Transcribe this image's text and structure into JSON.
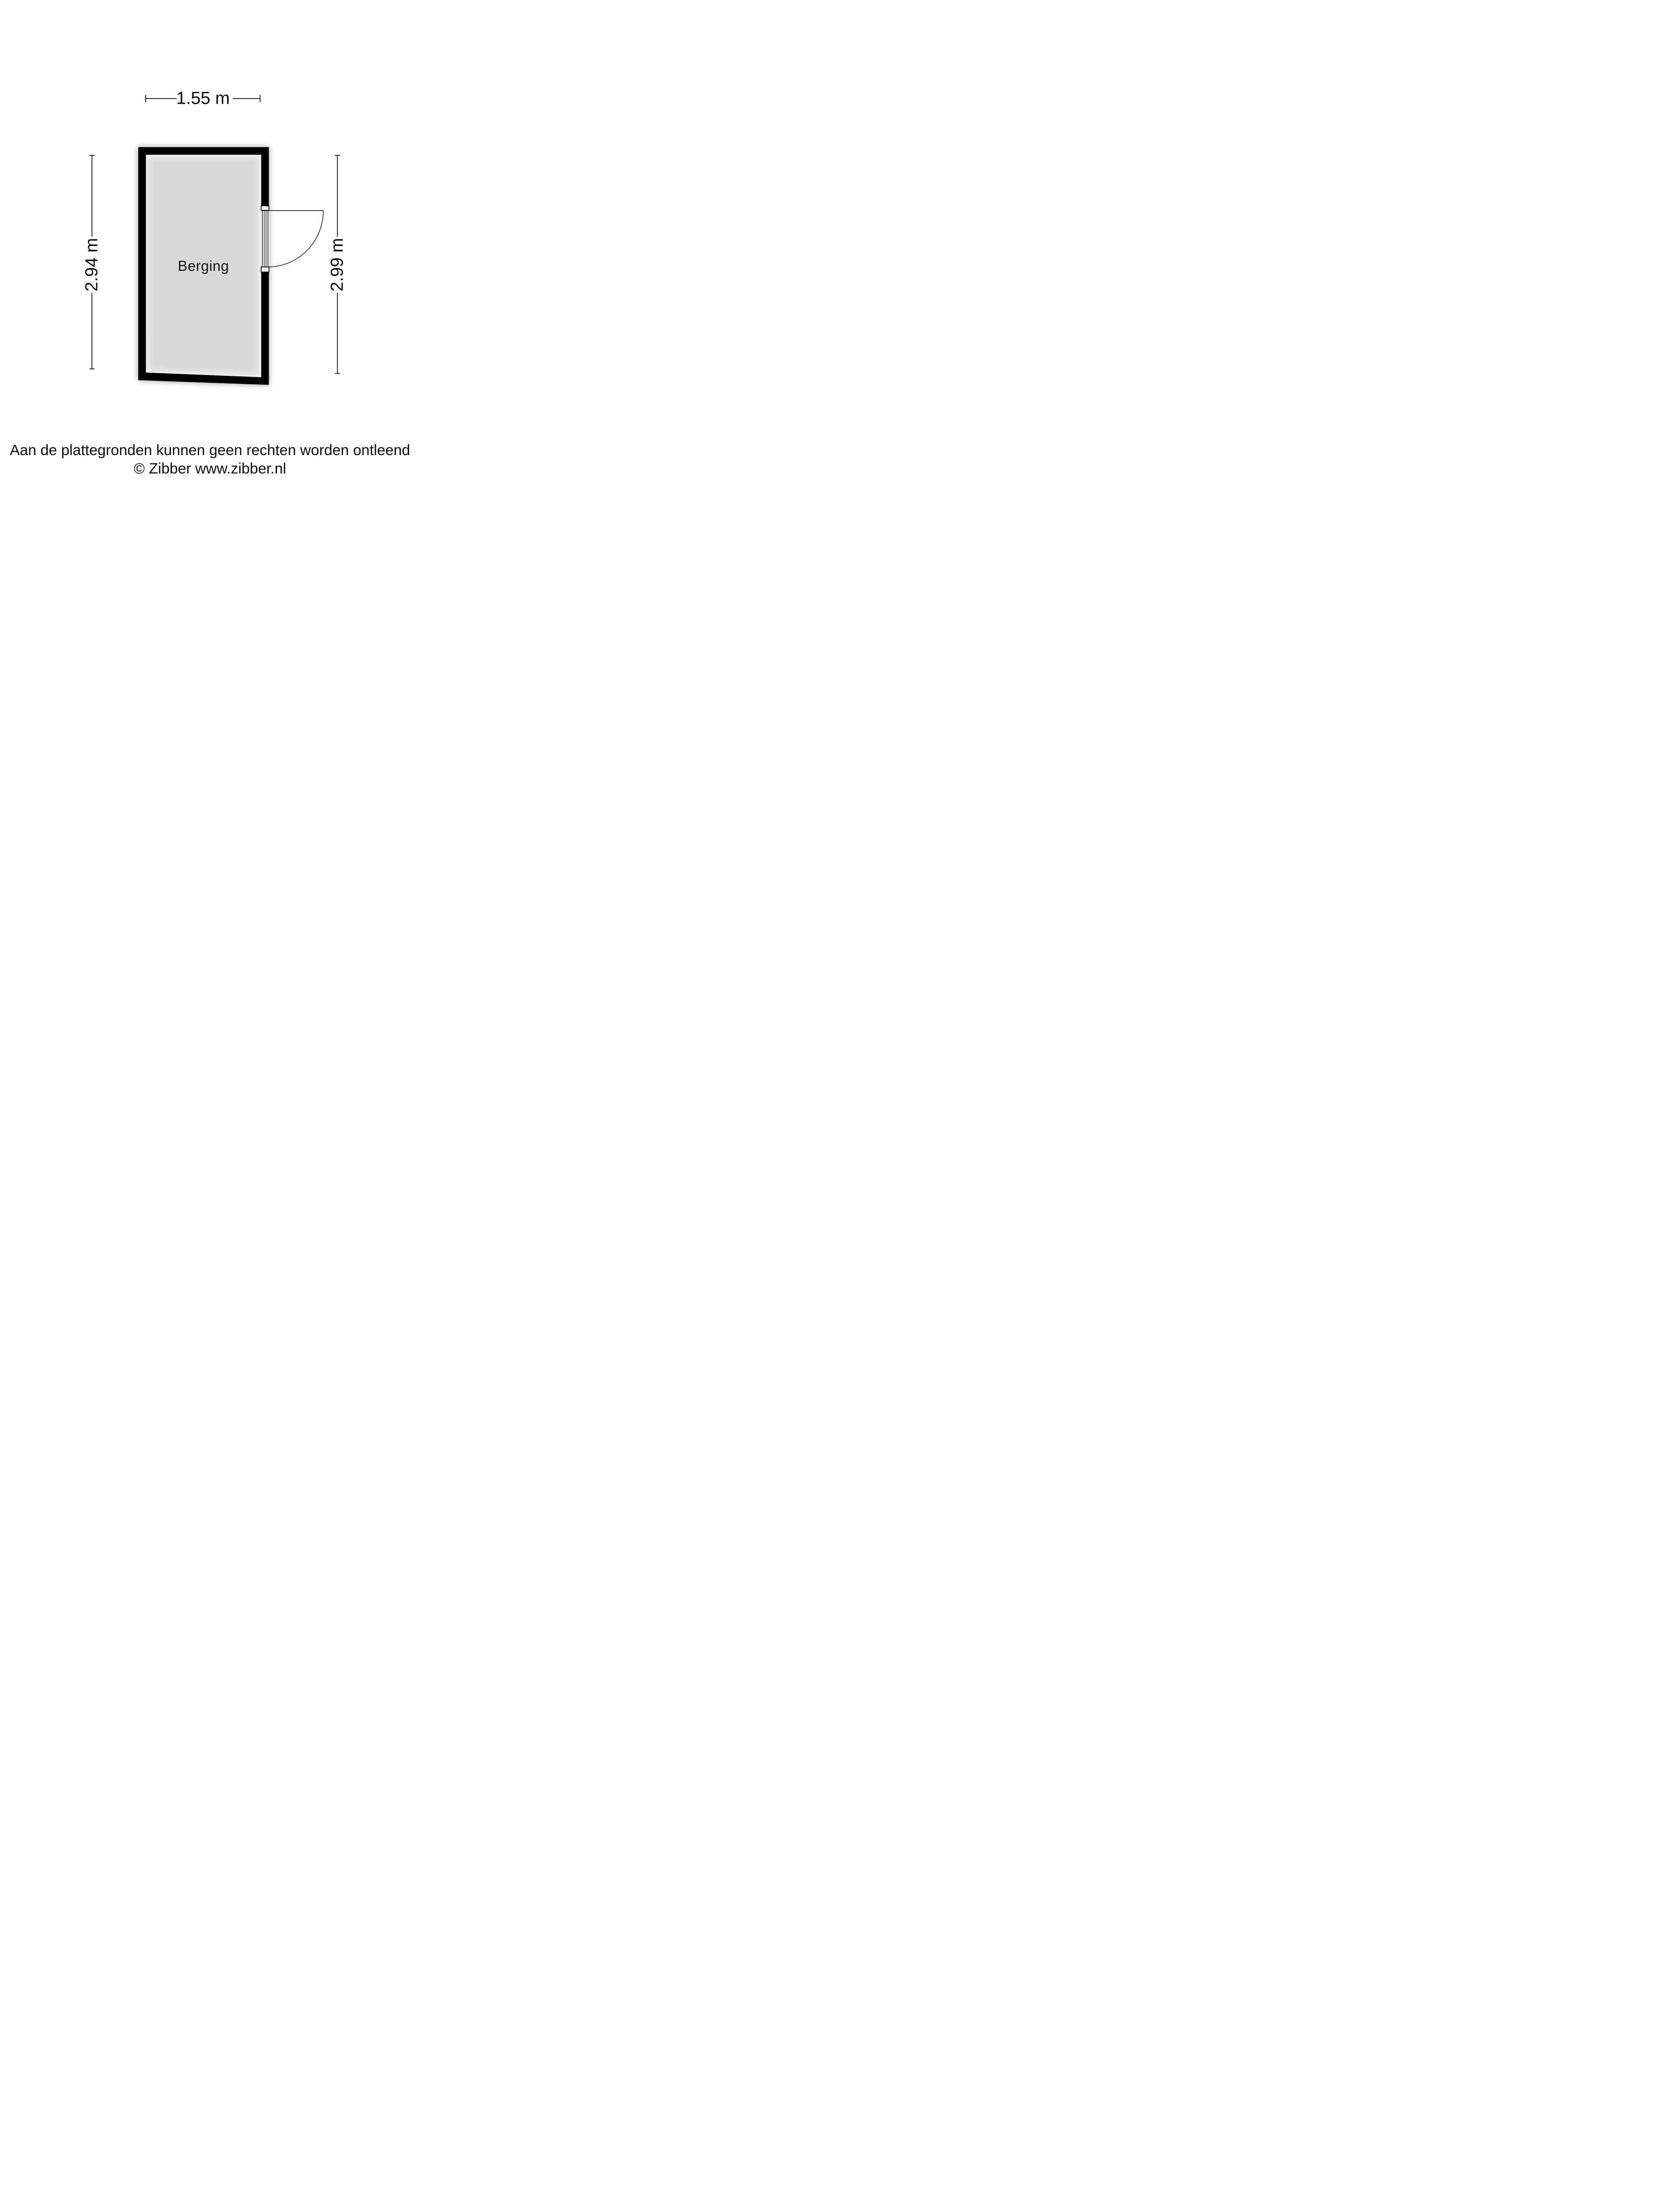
{
  "floorplan": {
    "room": {
      "label": "Berging",
      "floor_color": "#d9d9d9",
      "wall_color": "#000000",
      "door": {
        "type": "single-swing-door",
        "wall_side": "right",
        "swing": "opens-outward-right"
      }
    },
    "dimensions": {
      "top": {
        "label": "1.55 m"
      },
      "left": {
        "label": "2.94 m"
      },
      "right": {
        "label": "2.99 m"
      }
    }
  },
  "footer": {
    "disclaimer": "Aan de plattegronden kunnen geen rechten worden ontleend",
    "copyright": "© Zibber www.zibber.nl"
  }
}
